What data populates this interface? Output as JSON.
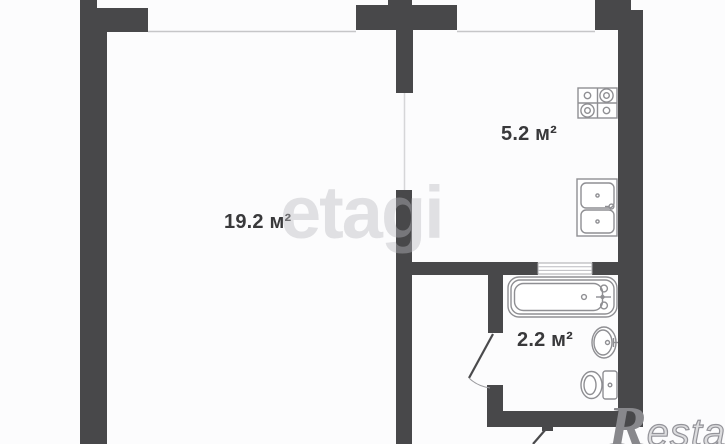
{
  "plan": {
    "title": "one-room apartment floor plan",
    "rooms": [
      {
        "name": "living-room",
        "area_label": "19.2 м²"
      },
      {
        "name": "kitchen",
        "area_label": "5.2 м²"
      },
      {
        "name": "bathroom",
        "area_label": "2.2 м²"
      }
    ],
    "fixtures": [
      "stove-icon",
      "kitchen-sink-icon",
      "bathtub-icon",
      "washbasin-icon",
      "toilet-icon"
    ],
    "colors": {
      "wall": "#48484a",
      "window_line": "#c6c6c8",
      "door_line": "#d6d6d8",
      "door_leaf": "#4a4a4c",
      "arc": "#9a9a9e",
      "fixture": "#8f8f93",
      "text": "#39393b",
      "background": "#fcfcfd"
    }
  },
  "watermarks": {
    "center": "etagi",
    "logo_initial": "R",
    "logo_rest": "estate"
  }
}
